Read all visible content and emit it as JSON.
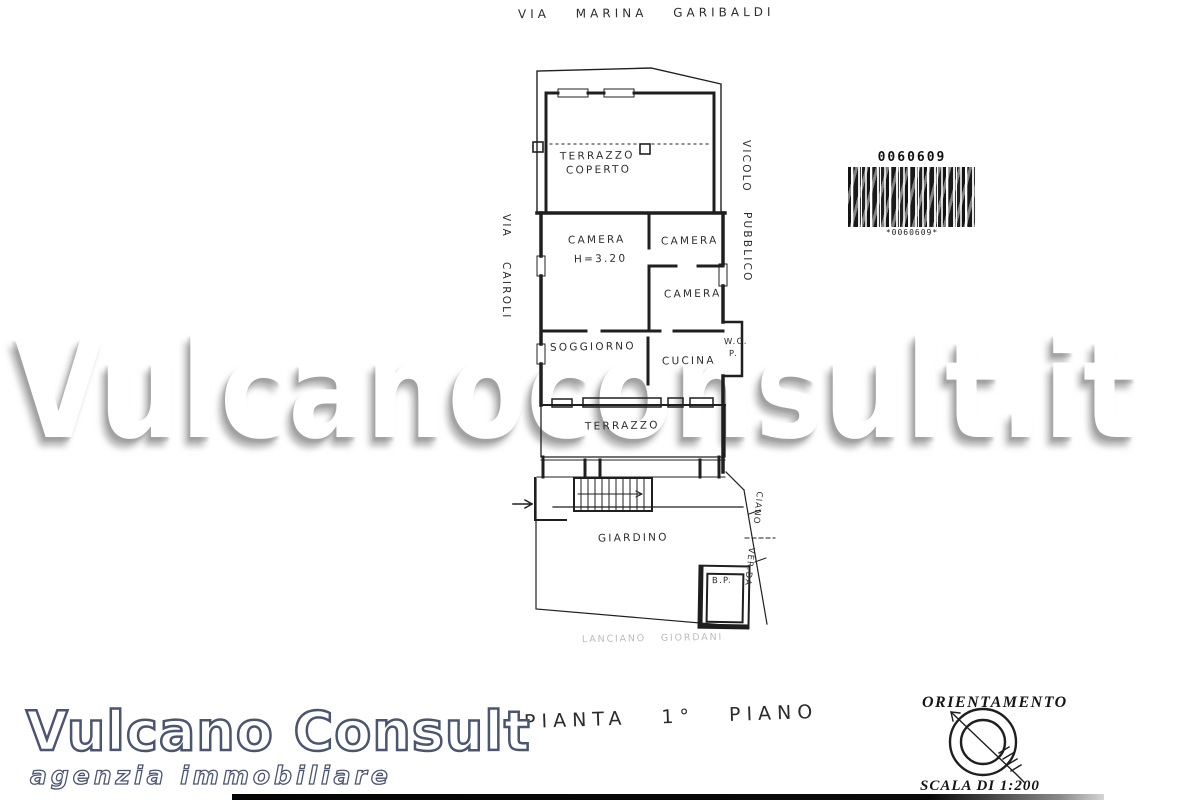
{
  "header": {
    "street_top": "VIA MARINA GARIBALDI"
  },
  "barcode": {
    "number": "0060609",
    "footer": "*0060609*"
  },
  "watermark": {
    "text": "Vulcanoconsult.it"
  },
  "plan": {
    "labels": {
      "terrazzo_coperto_line1": "TERRAZZO",
      "terrazzo_coperto_line2": "COPERTO",
      "camera_main": "CAMERA",
      "camera_main_height": "H=3.20",
      "camera_top_right": "CAMERA",
      "camera_mid_right": "CAMERA",
      "soggiorno": "SOGGIORNO",
      "cucina": "CUCINA",
      "wc_line1": "W.C.",
      "wc_line2": "P.",
      "terrazzo_balcony": "TERRAZZO",
      "giardino": "GIARDINO",
      "outbuilding": "B.P."
    },
    "streets": {
      "left_line1": "VIA",
      "left_line2": "CAIROLI",
      "right_line1": "VICOLO",
      "right_line2": "PUBBLICO",
      "boundary_lower_line1": "CIANO",
      "boundary_lower_line2": "VER.DA",
      "bottom_note": "LANCIANO GIORDANI"
    }
  },
  "caption": {
    "text": "PIANTA 1° PIANO"
  },
  "orientation": {
    "title": "ORIENTAMENTO",
    "scale": "SCALA DI 1:200"
  },
  "logo": {
    "title": "Vulcano Consult",
    "subtitle": "agenzia immobiliare"
  },
  "colors": {
    "logo_outline": "#4a5570",
    "plan_line": "#1f1f1f",
    "watermark_shadow": "#8c8c8c"
  }
}
